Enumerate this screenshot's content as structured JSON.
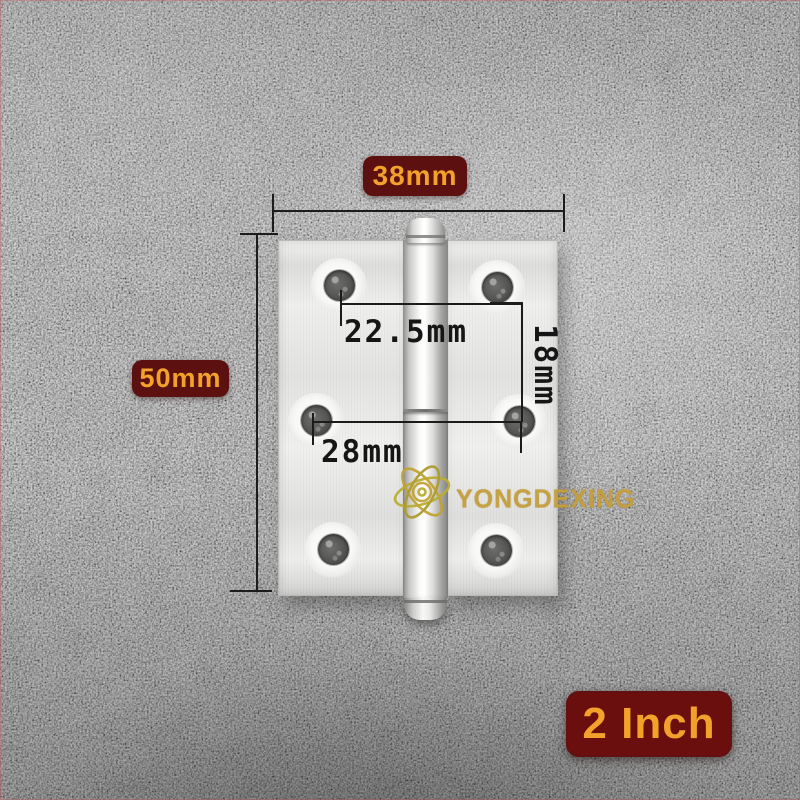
{
  "image": {
    "type": "product-photo",
    "subject": "stainless steel butt door hinge on gray concrete background"
  },
  "annotations": {
    "width_label": "38mm",
    "height_label": "50mm",
    "top_hole_spacing": "22.5mm",
    "vertical_hole_spacing": "18mm",
    "middle_hole_spacing": "28mm",
    "size_badge": "2 Inch"
  },
  "brand": {
    "name": "YONGDEXING",
    "logo": "atom-icon"
  },
  "colors": {
    "label_background": "#5d1010",
    "size_badge_background": "#6b0e0e",
    "label_text_gold": "#f2a22a",
    "dimension_ink": "#1c1c1c",
    "brand_gold": "#c59f3c",
    "hinge_silver": "#e9e9e7",
    "background_gray": "#8d8d8d"
  }
}
